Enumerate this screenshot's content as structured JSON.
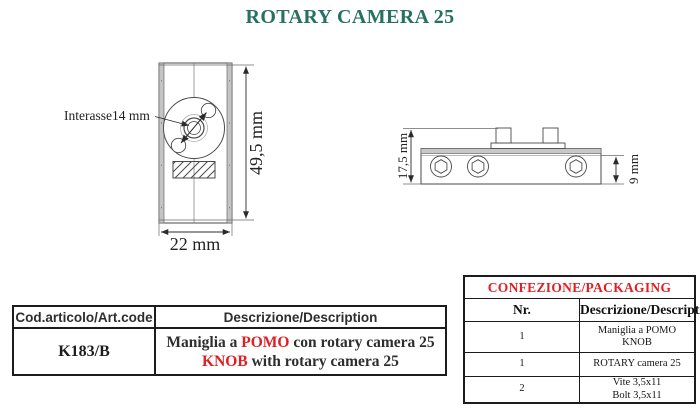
{
  "title": "ROTARY CAMERA 25",
  "colors": {
    "title_teal": "#26715f",
    "accent_red": "#e31e22",
    "line_dark": "#4a4a4a",
    "strip_gray": "#c4c4c4"
  },
  "front_view": {
    "interasse_label": "Interasse14 mm",
    "height_label": "49,5 mm",
    "width_label": "22 mm"
  },
  "side_view": {
    "total_height_label": "17,5 mm",
    "body_height_label": "9 mm"
  },
  "article_table": {
    "headers": [
      "Cod.articolo/Art.code",
      "Descrizione/Description"
    ],
    "row": {
      "code": "K183/B",
      "desc_line1_pre": "Maniglia a ",
      "desc_line1_red": "POMO",
      "desc_line1_post": " con rotary camera 25",
      "desc_line2_red": "KNOB",
      "desc_line2_post": " with rotary camera 25"
    }
  },
  "packaging_table": {
    "title": "CONFEZIONE/PACKAGING",
    "headers": [
      "Nr.",
      "Descrizione/Description"
    ],
    "rows": [
      {
        "nr": "1",
        "desc_line1": "Maniglia a POMO",
        "desc_line2": "KNOB"
      },
      {
        "nr": "1",
        "desc_line1": "ROTARY camera 25",
        "desc_line2": ""
      },
      {
        "nr": "2",
        "desc_line1": "Vite 3,5x11",
        "desc_line2": "Bolt 3,5x11"
      }
    ]
  }
}
